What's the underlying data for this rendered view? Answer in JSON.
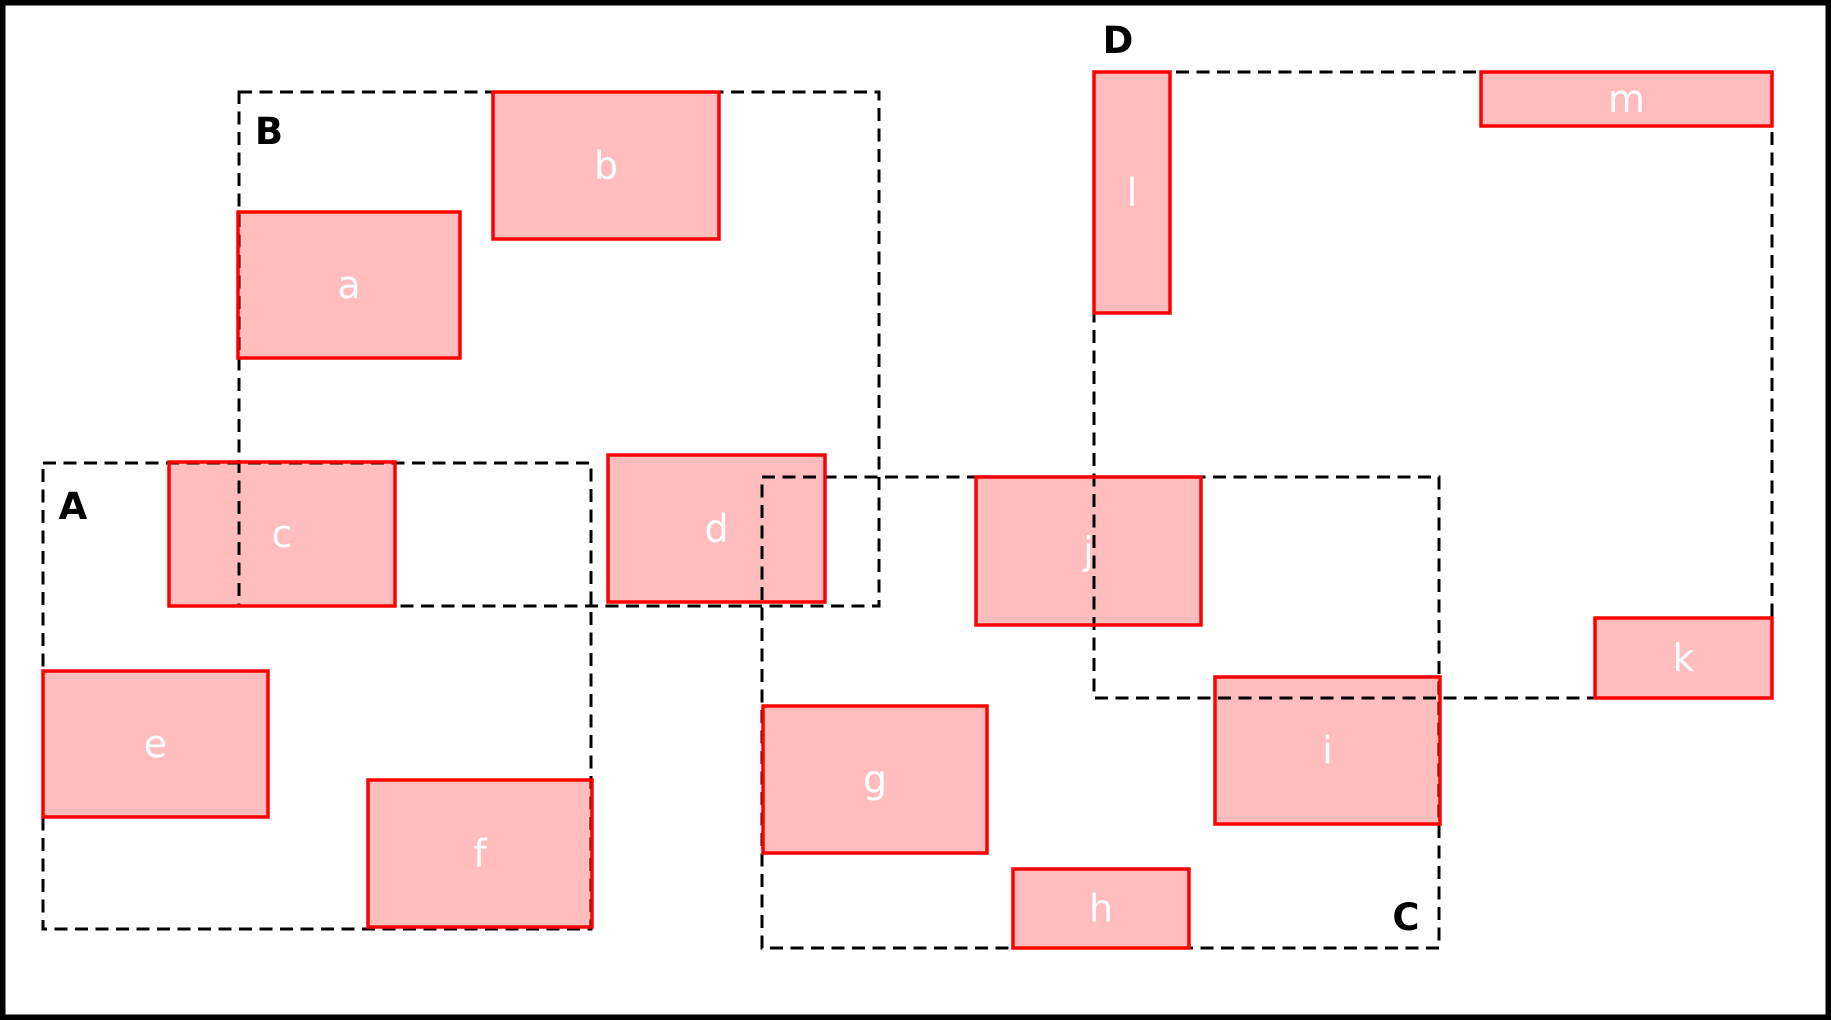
{
  "canvas": {
    "width": 1831,
    "height": 1020,
    "background": "#ffffff",
    "outer_border_color": "#000000",
    "outer_border_width": 5.5
  },
  "colors": {
    "box_fill": "#ffbdbd",
    "box_border": "#fe0000",
    "box_border_width": 3.5,
    "dashed_stroke": "#000000",
    "dashed_stroke_width": 3,
    "dash_pattern": "13 7.5",
    "box_label_color": "#ffffff",
    "region_label_color": "#000000"
  },
  "regions": [
    {
      "label": "A",
      "x": 43,
      "y": 463,
      "w": 548,
      "h": 466,
      "label_x": 73,
      "label_y": 506
    },
    {
      "label": "B",
      "x": 239,
      "y": 92,
      "w": 640,
      "h": 514,
      "label_x": 269,
      "label_y": 131
    },
    {
      "label": "C",
      "x": 762,
      "y": 477,
      "w": 677,
      "h": 471,
      "label_x": 1406,
      "label_y": 917
    },
    {
      "label": "D",
      "x": 1094,
      "y": 72,
      "w": 678,
      "h": 626,
      "label_x": 1118,
      "label_y": 40
    }
  ],
  "boxes": [
    {
      "label": "a",
      "x": 238,
      "y": 212,
      "w": 222,
      "h": 146
    },
    {
      "label": "b",
      "x": 493,
      "y": 92,
      "w": 226,
      "h": 147
    },
    {
      "label": "c",
      "x": 169,
      "y": 462,
      "w": 226,
      "h": 144
    },
    {
      "label": "d",
      "x": 608,
      "y": 455,
      "w": 217,
      "h": 147
    },
    {
      "label": "e",
      "x": 43,
      "y": 671,
      "w": 225,
      "h": 146
    },
    {
      "label": "f",
      "x": 368,
      "y": 780,
      "w": 224,
      "h": 147
    },
    {
      "label": "g",
      "x": 763,
      "y": 706,
      "w": 224,
      "h": 147
    },
    {
      "label": "h",
      "x": 1013,
      "y": 869,
      "w": 176,
      "h": 79
    },
    {
      "label": "i",
      "x": 1215,
      "y": 677,
      "w": 225,
      "h": 147
    },
    {
      "label": "j",
      "x": 976,
      "y": 477,
      "w": 225,
      "h": 148
    },
    {
      "label": "k",
      "x": 1595,
      "y": 618,
      "w": 177,
      "h": 80
    },
    {
      "label": "l",
      "x": 1094,
      "y": 72,
      "w": 76,
      "h": 241
    },
    {
      "label": "m",
      "x": 1481,
      "y": 72,
      "w": 291,
      "h": 54
    }
  ]
}
